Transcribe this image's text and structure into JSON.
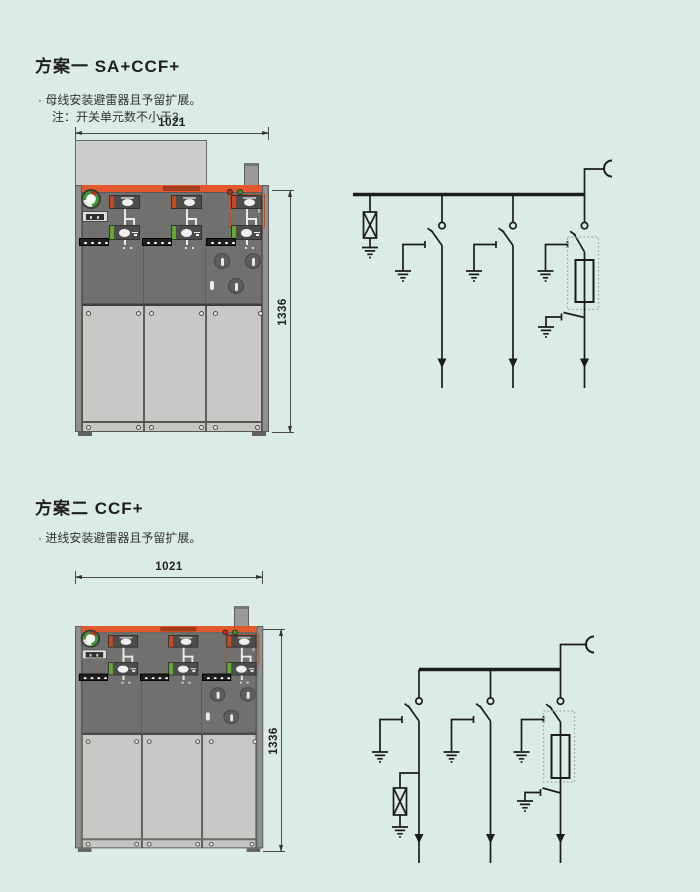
{
  "page": {
    "bg_color": "#dbebe6"
  },
  "scheme1": {
    "title": "方案一 SA+CCF+",
    "bullet": "· 母线安装避雷器且予留扩展。",
    "note": "注：开关单元数不小于3。",
    "dim_width": "1021",
    "dim_height": "1336"
  },
  "scheme2": {
    "title": "方案二 CCF+",
    "bullet": "· 进线安装避雷器且予留扩展。",
    "dim_width": "1021",
    "dim_height": "1336"
  },
  "colors": {
    "accent_orange": "#e1592c",
    "panel_dark": "#70706e",
    "door_gray": "#c9c8c6",
    "schematic_line": "#1c1c1c",
    "indicator_red": "#bf2a22",
    "indicator_green": "#38982e"
  }
}
